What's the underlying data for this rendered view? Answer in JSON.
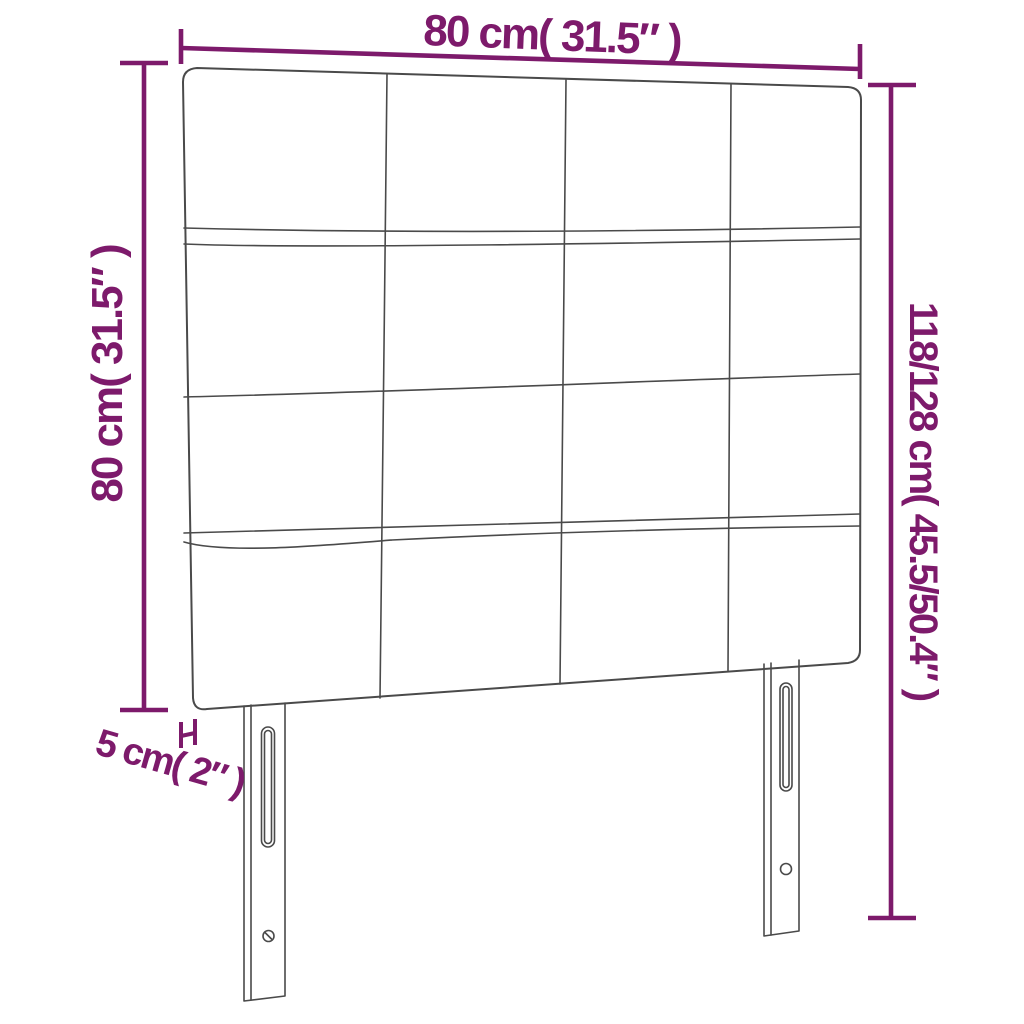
{
  "theme": {
    "background": "#FFFFFF",
    "accent_color": "#7D1A6B",
    "line_color": "#4A4A4A"
  },
  "diagram": {
    "type": "product-dimension-diagram",
    "product": "upholstered-headboard-with-two-legs",
    "grid": {
      "rows": 4,
      "columns": 4
    }
  },
  "labels": {
    "width": "80 cm( 31.5″ )",
    "height": "80 cm( 31.5″ )",
    "total_height": "118/128 cm( 45.5/50.4″ )",
    "thickness": "5 cm( 2″ )"
  }
}
